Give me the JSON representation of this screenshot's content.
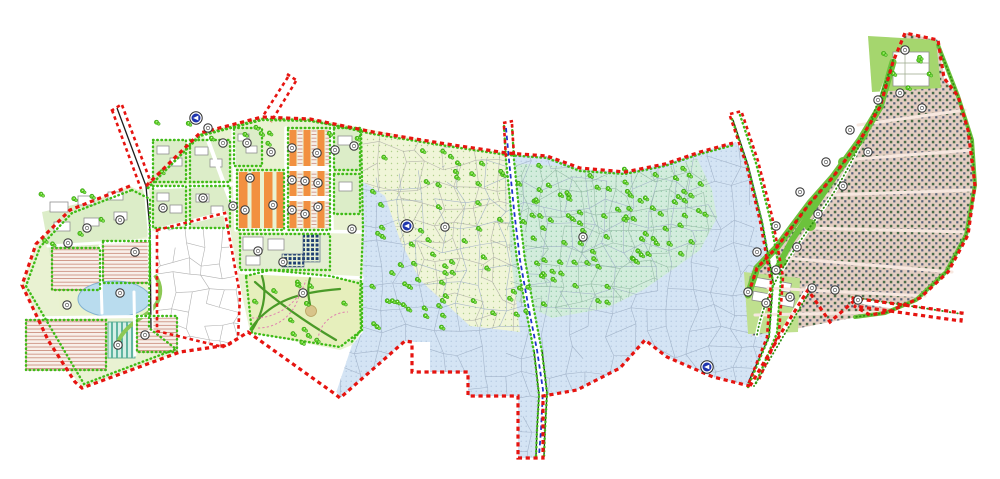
{
  "document": {
    "type": "urban-master-plan-site-drawing",
    "background": "#ffffff",
    "visible_text": "none"
  },
  "palette": {
    "boundary_red": "#e61410",
    "street_tree_green": "#3fbb17",
    "band_green": "#6cc23c",
    "tree_green": "#5ed122",
    "tree_ring": "#2f9b10",
    "orange_block": "#f29040",
    "navy_block": "#1e3f72",
    "canal_blue": "#2233cc",
    "arrow_blue": "#1f35ae",
    "lake_blue": "#b9dcee",
    "district_green": "#e9f2d2",
    "housing_court_green": "#dcedc8",
    "park_green": "#e6efbc",
    "zone_yellow": "#f0f5d8",
    "zone_teal": "#d2ecdc",
    "zone_blue": "#d4e4f4",
    "zone_white": "#ffffff",
    "crescent_tan": "#e4cec2",
    "row_housing_pink": "#f8efe9",
    "row_line_pink": "#c88876",
    "teal_stripe_block": "#d6efe6"
  },
  "zones": [
    {
      "name": "existing-fabric-blue-zone",
      "fill": "#d4e4f4",
      "dot_pattern": "pat-blue-dots",
      "parcel_color": "#9fb0c6",
      "parcel_cell": 21,
      "polygon": [
        [
          363,
          180
        ],
        [
          505,
          155
        ],
        [
          547,
          156
        ],
        [
          580,
          169
        ],
        [
          625,
          172
        ],
        [
          665,
          164
        ],
        [
          700,
          152
        ],
        [
          736,
          142
        ],
        [
          754,
          168
        ],
        [
          768,
          224
        ],
        [
          778,
          282
        ],
        [
          772,
          338
        ],
        [
          750,
          386
        ],
        [
          713,
          377
        ],
        [
          667,
          357
        ],
        [
          645,
          340
        ],
        [
          620,
          369
        ],
        [
          577,
          390
        ],
        [
          543,
          396
        ],
        [
          543,
          458
        ],
        [
          518,
          458
        ],
        [
          518,
          396
        ],
        [
          468,
          396
        ],
        [
          468,
          372
        ],
        [
          430,
          372
        ],
        [
          430,
          342
        ],
        [
          412,
          342
        ],
        [
          405,
          341
        ],
        [
          340,
          398
        ],
        [
          336,
          393
        ],
        [
          352,
          345
        ],
        [
          363,
          332
        ]
      ]
    },
    {
      "name": "green-buffer-teal-zone",
      "fill": "#d2ecdc",
      "dot_pattern": "pat-teal-dots",
      "parcel_color": "#93b8a4",
      "parcel_cell": 18,
      "polygon": [
        [
          509,
          163
        ],
        [
          560,
          166
        ],
        [
          620,
          174
        ],
        [
          660,
          170
        ],
        [
          697,
          158
        ],
        [
          712,
          190
        ],
        [
          717,
          218
        ],
        [
          700,
          250
        ],
        [
          672,
          270
        ],
        [
          643,
          290
        ],
        [
          607,
          308
        ],
        [
          552,
          318
        ],
        [
          515,
          300
        ],
        [
          507,
          268
        ],
        [
          507,
          200
        ]
      ]
    },
    {
      "name": "orchard-yellow-zone",
      "fill": "#f0f5d8",
      "dot_pattern": "pat-yellow-dots",
      "parcel_color": "#b0b0a8",
      "parcel_cell": 19,
      "polygon": [
        [
          363,
          128
        ],
        [
          440,
          143
        ],
        [
          507,
          153
        ],
        [
          510,
          250
        ],
        [
          520,
          332
        ],
        [
          470,
          326
        ],
        [
          420,
          280
        ],
        [
          400,
          240
        ],
        [
          385,
          196
        ],
        [
          370,
          186
        ],
        [
          363,
          182
        ]
      ]
    },
    {
      "name": "excluded-village-white-zone",
      "fill": "#ffffff",
      "dot_pattern": null,
      "parcel_color": "#a9a9a9",
      "parcel_cell": 16,
      "polygon": [
        [
          157,
          230
        ],
        [
          225,
          213
        ],
        [
          240,
          295
        ],
        [
          238,
          338
        ],
        [
          223,
          347
        ],
        [
          157,
          331
        ]
      ]
    }
  ],
  "tree_patches": [
    {
      "name": "teal-zone-trees",
      "count": 92,
      "polygon": [
        [
          512,
          168
        ],
        [
          560,
          170
        ],
        [
          620,
          178
        ],
        [
          658,
          174
        ],
        [
          694,
          162
        ],
        [
          708,
          192
        ],
        [
          713,
          218
        ],
        [
          697,
          248
        ],
        [
          670,
          268
        ],
        [
          641,
          288
        ],
        [
          606,
          305
        ],
        [
          553,
          315
        ],
        [
          518,
          298
        ],
        [
          510,
          266
        ],
        [
          510,
          200
        ]
      ]
    },
    {
      "name": "yellow-zone-trees",
      "count": 50,
      "polygon": [
        [
          366,
          132
        ],
        [
          440,
          146
        ],
        [
          504,
          156
        ],
        [
          507,
          250
        ],
        [
          516,
          328
        ],
        [
          472,
          322
        ],
        [
          423,
          278
        ],
        [
          403,
          240
        ],
        [
          388,
          196
        ],
        [
          372,
          188
        ],
        [
          366,
          184
        ]
      ]
    },
    {
      "name": "blue-lobe-trees",
      "count": 9,
      "polygon": [
        [
          365,
          200
        ],
        [
          418,
          242
        ],
        [
          428,
          330
        ],
        [
          365,
          330
        ]
      ]
    },
    {
      "name": "park-trees",
      "count": 13,
      "polygon": [
        [
          250,
          278
        ],
        [
          330,
          278
        ],
        [
          358,
          288
        ],
        [
          358,
          328
        ],
        [
          340,
          344
        ],
        [
          254,
          331
        ]
      ]
    },
    {
      "name": "d2-top-edge-trees",
      "count": 11,
      "polygon": [
        [
          152,
          186
        ],
        [
          200,
          135
        ],
        [
          262,
          119
        ],
        [
          360,
          130
        ],
        [
          360,
          140
        ],
        [
          205,
          150
        ]
      ]
    },
    {
      "name": "d1-north-trees",
      "count": 8,
      "polygon": [
        [
          36,
          244
        ],
        [
          130,
          188
        ],
        [
          148,
          200
        ],
        [
          48,
          258
        ]
      ]
    },
    {
      "name": "crescent-tip-trees",
      "count": 6,
      "polygon": [
        [
          870,
          38
        ],
        [
          934,
          42
        ],
        [
          938,
          88
        ],
        [
          874,
          90
        ]
      ]
    }
  ],
  "key_plan_markers": [
    [
      87,
      228
    ],
    [
      120,
      220
    ],
    [
      68,
      243
    ],
    [
      135,
      252
    ],
    [
      120,
      293
    ],
    [
      67,
      305
    ],
    [
      145,
      335
    ],
    [
      118,
      345
    ],
    [
      163,
      208
    ],
    [
      203,
      198
    ],
    [
      233,
      206
    ],
    [
      208,
      128
    ],
    [
      223,
      143
    ],
    [
      247,
      143
    ],
    [
      271,
      152
    ],
    [
      292,
      148
    ],
    [
      317,
      153
    ],
    [
      335,
      150
    ],
    [
      354,
      146
    ],
    [
      250,
      178
    ],
    [
      245,
      210
    ],
    [
      273,
      205
    ],
    [
      292,
      180
    ],
    [
      305,
      181
    ],
    [
      318,
      183
    ],
    [
      292,
      210
    ],
    [
      305,
      214
    ],
    [
      318,
      207
    ],
    [
      352,
      229
    ],
    [
      258,
      251
    ],
    [
      283,
      262
    ],
    [
      303,
      293
    ],
    [
      445,
      227
    ],
    [
      583,
      237
    ],
    [
      905,
      50
    ],
    [
      900,
      93
    ],
    [
      922,
      108
    ],
    [
      878,
      100
    ],
    [
      850,
      130
    ],
    [
      868,
      152
    ],
    [
      826,
      162
    ],
    [
      843,
      186
    ],
    [
      800,
      192
    ],
    [
      818,
      214
    ],
    [
      776,
      226
    ],
    [
      797,
      247
    ],
    [
      757,
      252
    ],
    [
      776,
      270
    ],
    [
      748,
      292
    ],
    [
      766,
      303
    ],
    [
      790,
      297
    ],
    [
      812,
      288
    ],
    [
      835,
      290
    ],
    [
      858,
      300
    ]
  ],
  "direction_arrow_markers": [
    [
      196,
      118
    ],
    [
      407,
      226
    ],
    [
      707,
      367
    ]
  ],
  "marker_style": {
    "radius": 4.2,
    "fill": "#ffffff",
    "ring": "#3a3a3a"
  },
  "arrow_style": {
    "radius": 6.2,
    "disc": "#1f35ae",
    "glyph": "left-triangle",
    "glyph_color": "#ffffff"
  }
}
